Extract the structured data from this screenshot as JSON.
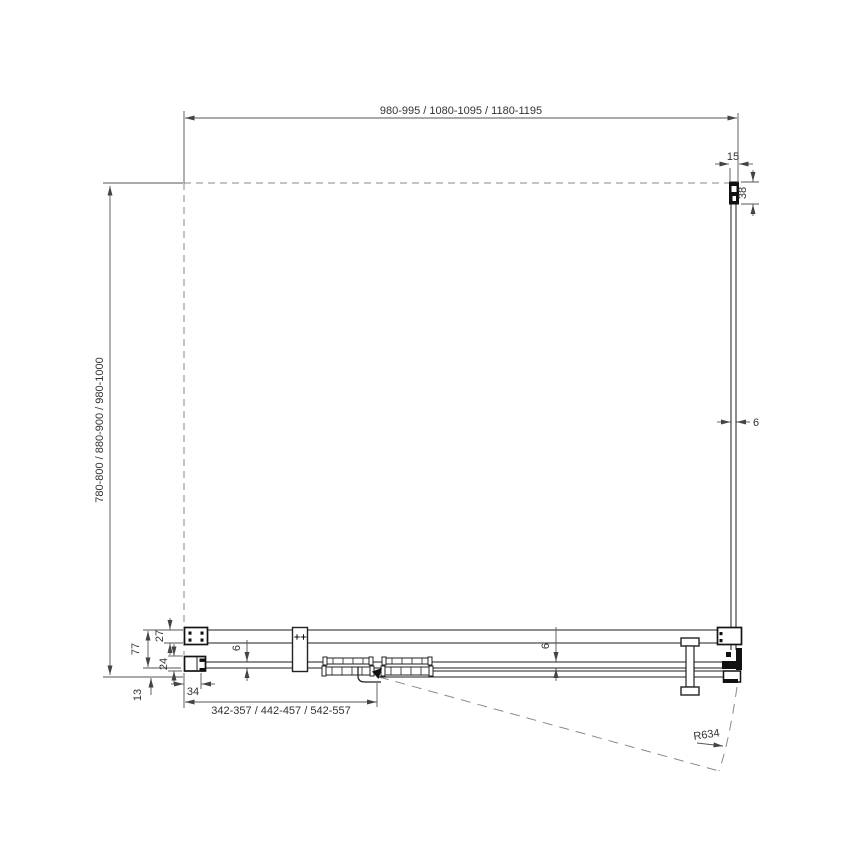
{
  "dimensions": {
    "top_width": "980-995 / 1080-1095 / 1180-1195",
    "left_height": "780-800 / 880-900 / 980-1000",
    "wall_profile_width": "15",
    "wall_profile_depth": "38",
    "side_glass_thickness": "6",
    "rail_depth": "27",
    "total_depth": "77",
    "bottom_profile_depth": "24",
    "bottom_offset": "13",
    "wall_profile_bottom_width": "34",
    "door_glass_thickness": "6",
    "fixed_glass_thickness": "6",
    "door_opening_width": "342-357 / 442-457 / 542-557",
    "swing_radius": "R634"
  },
  "colors": {
    "background": "#ffffff",
    "object_line": "#1d1d1d",
    "dimension_line": "#555555",
    "dashed_line": "#8a8a8a",
    "text": "#333333"
  }
}
